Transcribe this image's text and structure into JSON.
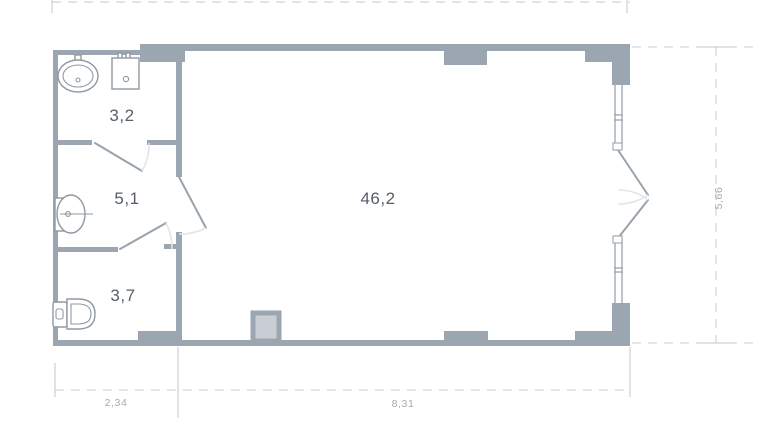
{
  "plan": {
    "title": "apartment-floor-plan",
    "rooms": [
      {
        "name": "bathroom",
        "area": "3,2"
      },
      {
        "name": "hallway",
        "area": "5,1"
      },
      {
        "name": "wc",
        "area": "3,7"
      },
      {
        "name": "living-room",
        "area": "46,2"
      }
    ],
    "dimensions": {
      "bottom_left": "2,34",
      "bottom_right": "8,31",
      "right_side": "5,66"
    },
    "fixtures": [
      {
        "name": "oval-sink"
      },
      {
        "name": "washing-machine"
      },
      {
        "name": "washbasin"
      },
      {
        "name": "toilet"
      }
    ],
    "colors": {
      "wall": "#9ba6b0",
      "fixture_outline": "#8f99a3",
      "door_line": "#99a3ac",
      "swing_arc": "#e1e5e8",
      "dash_line": "#c7cdd3",
      "room_text": "#555f69",
      "dim_text": "#a4abb3",
      "shaft_fill": "#c9ced4"
    }
  }
}
